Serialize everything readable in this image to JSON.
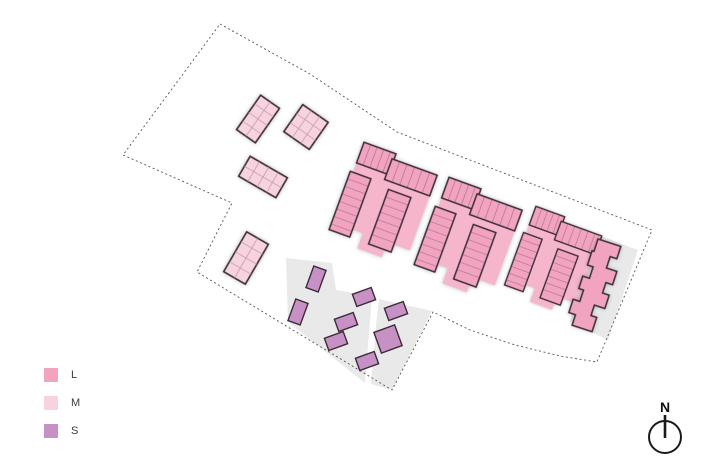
{
  "legend": {
    "items": [
      {
        "label": "L",
        "color": "#f2a3c0"
      },
      {
        "label": "M",
        "color": "#f7d3df"
      },
      {
        "label": "S",
        "color": "#c791c5"
      }
    ]
  },
  "compass": {
    "label": "N"
  },
  "plan": {
    "boundary_color": "#555555",
    "paved_area_color": "#e9e9e9",
    "building_outline_color": "#3a2b37",
    "building_counts": {
      "large": 4,
      "medium": 4,
      "small": 8
    }
  }
}
